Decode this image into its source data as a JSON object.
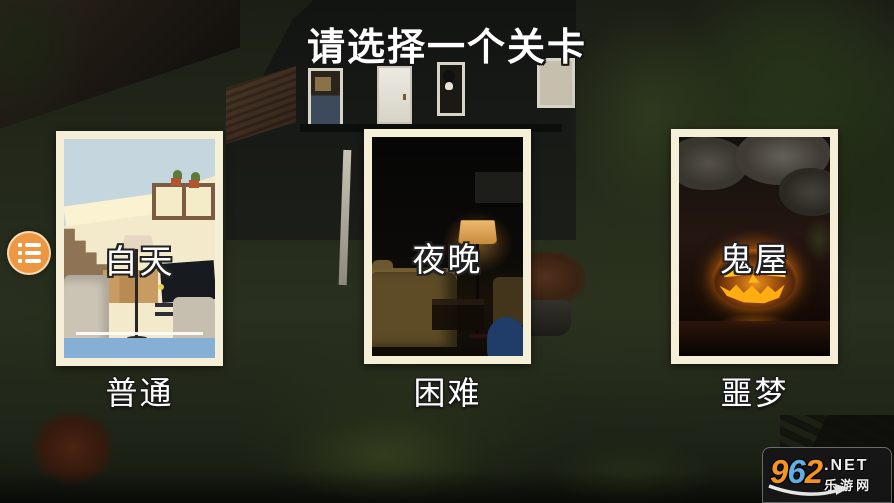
{
  "title": "请选择一个关卡",
  "menu": {
    "icon": "list-menu-icon"
  },
  "levels": [
    {
      "name": "白天",
      "difficulty": "普通",
      "scene": "day-living-room"
    },
    {
      "name": "夜晚",
      "difficulty": "困难",
      "scene": "night-living-room"
    },
    {
      "name": "鬼屋",
      "difficulty": "噩梦",
      "scene": "haunted-cave-pumpkin"
    }
  ],
  "watermark": {
    "digits": [
      "9",
      "6",
      "2"
    ],
    "tld": ".NET",
    "site_name": "乐游网"
  },
  "colors": {
    "card_border": "#F6EFD7",
    "menu_button": "#EE9742",
    "logo_orange": "#F7941E",
    "logo_blue": "#5FB0E5",
    "text": "#FFFFFF",
    "pumpkin_glow": "#FF8C19"
  }
}
